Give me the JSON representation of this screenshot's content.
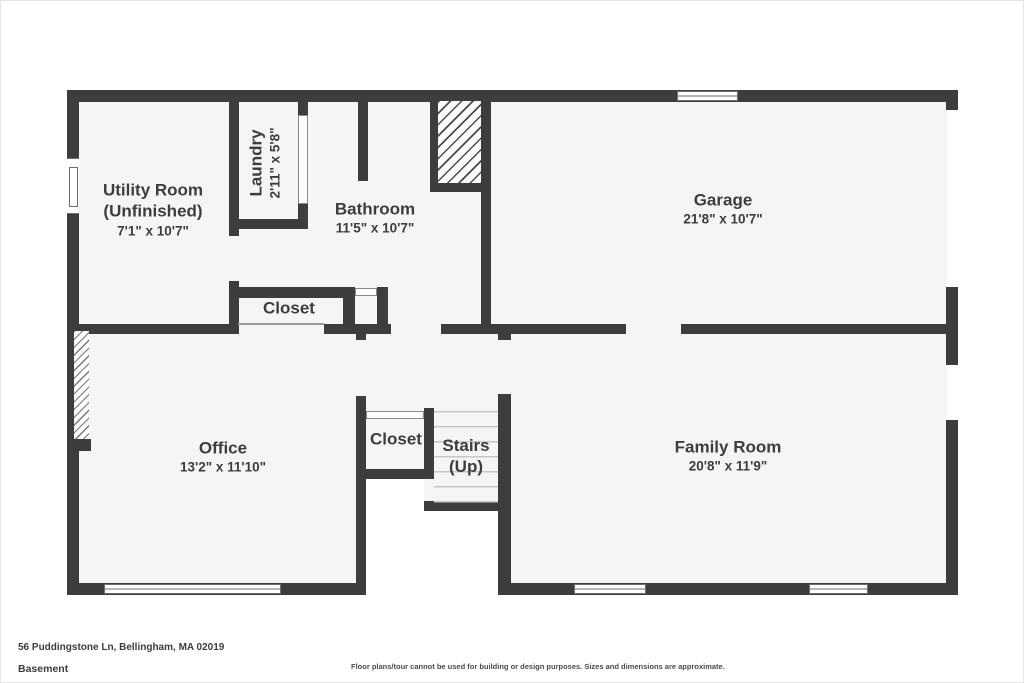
{
  "floorplan": {
    "address": "56 Puddingstone Ln, Bellingham, MA 02019",
    "level": "Basement",
    "disclaimer": "Floor plans/tour cannot be used for building or design purposes. Sizes and dimensions are approximate.",
    "colors": {
      "wall": "#3d3d3d",
      "floor": "#f5f5f5",
      "background": "#ffffff",
      "step_line": "#c7c7c7"
    },
    "rooms": [
      {
        "name": "Utility Room",
        "name2": "(Unfinished)",
        "dims": "7'1\" x 10'7\""
      },
      {
        "name": "Laundry",
        "dims": "2'11\" x 5'8\""
      },
      {
        "name": "Bathroom",
        "dims": "11'5\" x 10'7\""
      },
      {
        "name": "Garage",
        "dims": "21'8\" x 10'7\""
      },
      {
        "name": "Closet"
      },
      {
        "name": "Office",
        "dims": "13'2\" x 11'10\""
      },
      {
        "name": "Closet"
      },
      {
        "name": "Stairs",
        "name2": "(Up)"
      },
      {
        "name": "Family Room",
        "dims": "20'8\" x 11'9\""
      }
    ]
  }
}
